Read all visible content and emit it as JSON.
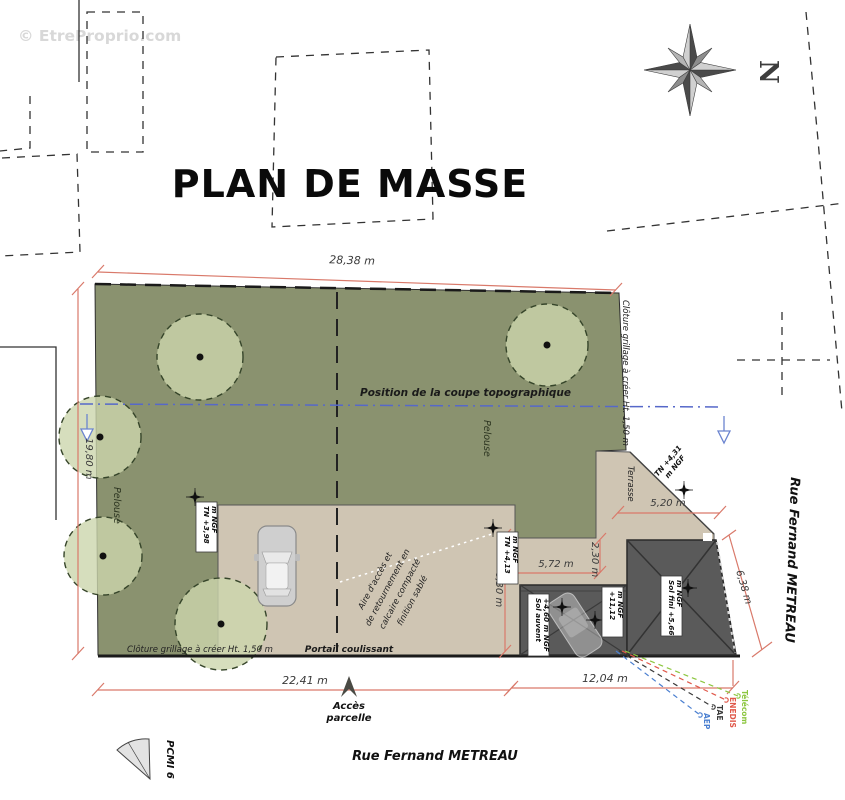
{
  "watermark": "© EtreProprio.com",
  "title": "PLAN DE MASSE",
  "compass": {
    "north_letter": "N"
  },
  "streets": {
    "bottom": "Rue Fernand METREAU",
    "right": "Rue Fernand METREAU"
  },
  "dimensions": {
    "top": "28,38 m",
    "left": "19,80 m",
    "bottom_left": "22,41 m",
    "bottom_right": "12,04 m",
    "right": "6,38 m",
    "terrace": "5,20 m",
    "band": "5,72 m",
    "band_depth": "2,30 m",
    "access_depth": "6,30 m"
  },
  "labels": {
    "coupe": "Position de la coupe topographique",
    "pelouse_main": "Pelouse",
    "pelouse_left": "Pelouse",
    "terrasse": "Terrasse",
    "aire": {
      "l1": "Aire d'accès et",
      "l2": "de retournement en",
      "l3": "calcaire compacté",
      "l4": "finition sablé"
    },
    "portail": "Portail coulissant",
    "cloture_bottom": "Clôture grillage à créer Ht. 1,50 m",
    "cloture_right": "Clôture grillage à créer Ht. 1,50 m",
    "acces": {
      "l1": "Accès",
      "l2": "parcelle"
    },
    "pcmi": "PCMI 6"
  },
  "levels": {
    "tn398": {
      "l1": "TN +3,98",
      "l2": "m NGF"
    },
    "tn413": {
      "l1": "TN +4,13",
      "l2": "m NGF"
    },
    "tn431": {
      "l1": "TN +4,31",
      "l2": "m NGF"
    },
    "sol_fini": {
      "l1": "Sol fini +5,66",
      "l2": "m NGF"
    },
    "sol_auvent": {
      "l1": "Sol auvent",
      "l2": "+4,60 m NGF"
    },
    "ridge": {
      "l1": "+11,12",
      "l2": "m NGF"
    }
  },
  "utilities": [
    {
      "name": "Télécom",
      "color": "#8cc63f"
    },
    {
      "name": "ENEDIS",
      "color": "#e0584a"
    },
    {
      "name": "TAE",
      "color": "#3a3a3a"
    },
    {
      "name": "AEP",
      "color": "#4a7fd0"
    }
  ],
  "colors": {
    "lawn": "#8a926f",
    "tree": "#ccd6ac",
    "paving": "#cfc5b3",
    "building": "#5a5a5a",
    "dimension": "#d9796a",
    "section_line": "#5668c9",
    "watermark": "#d8d8d8"
  }
}
